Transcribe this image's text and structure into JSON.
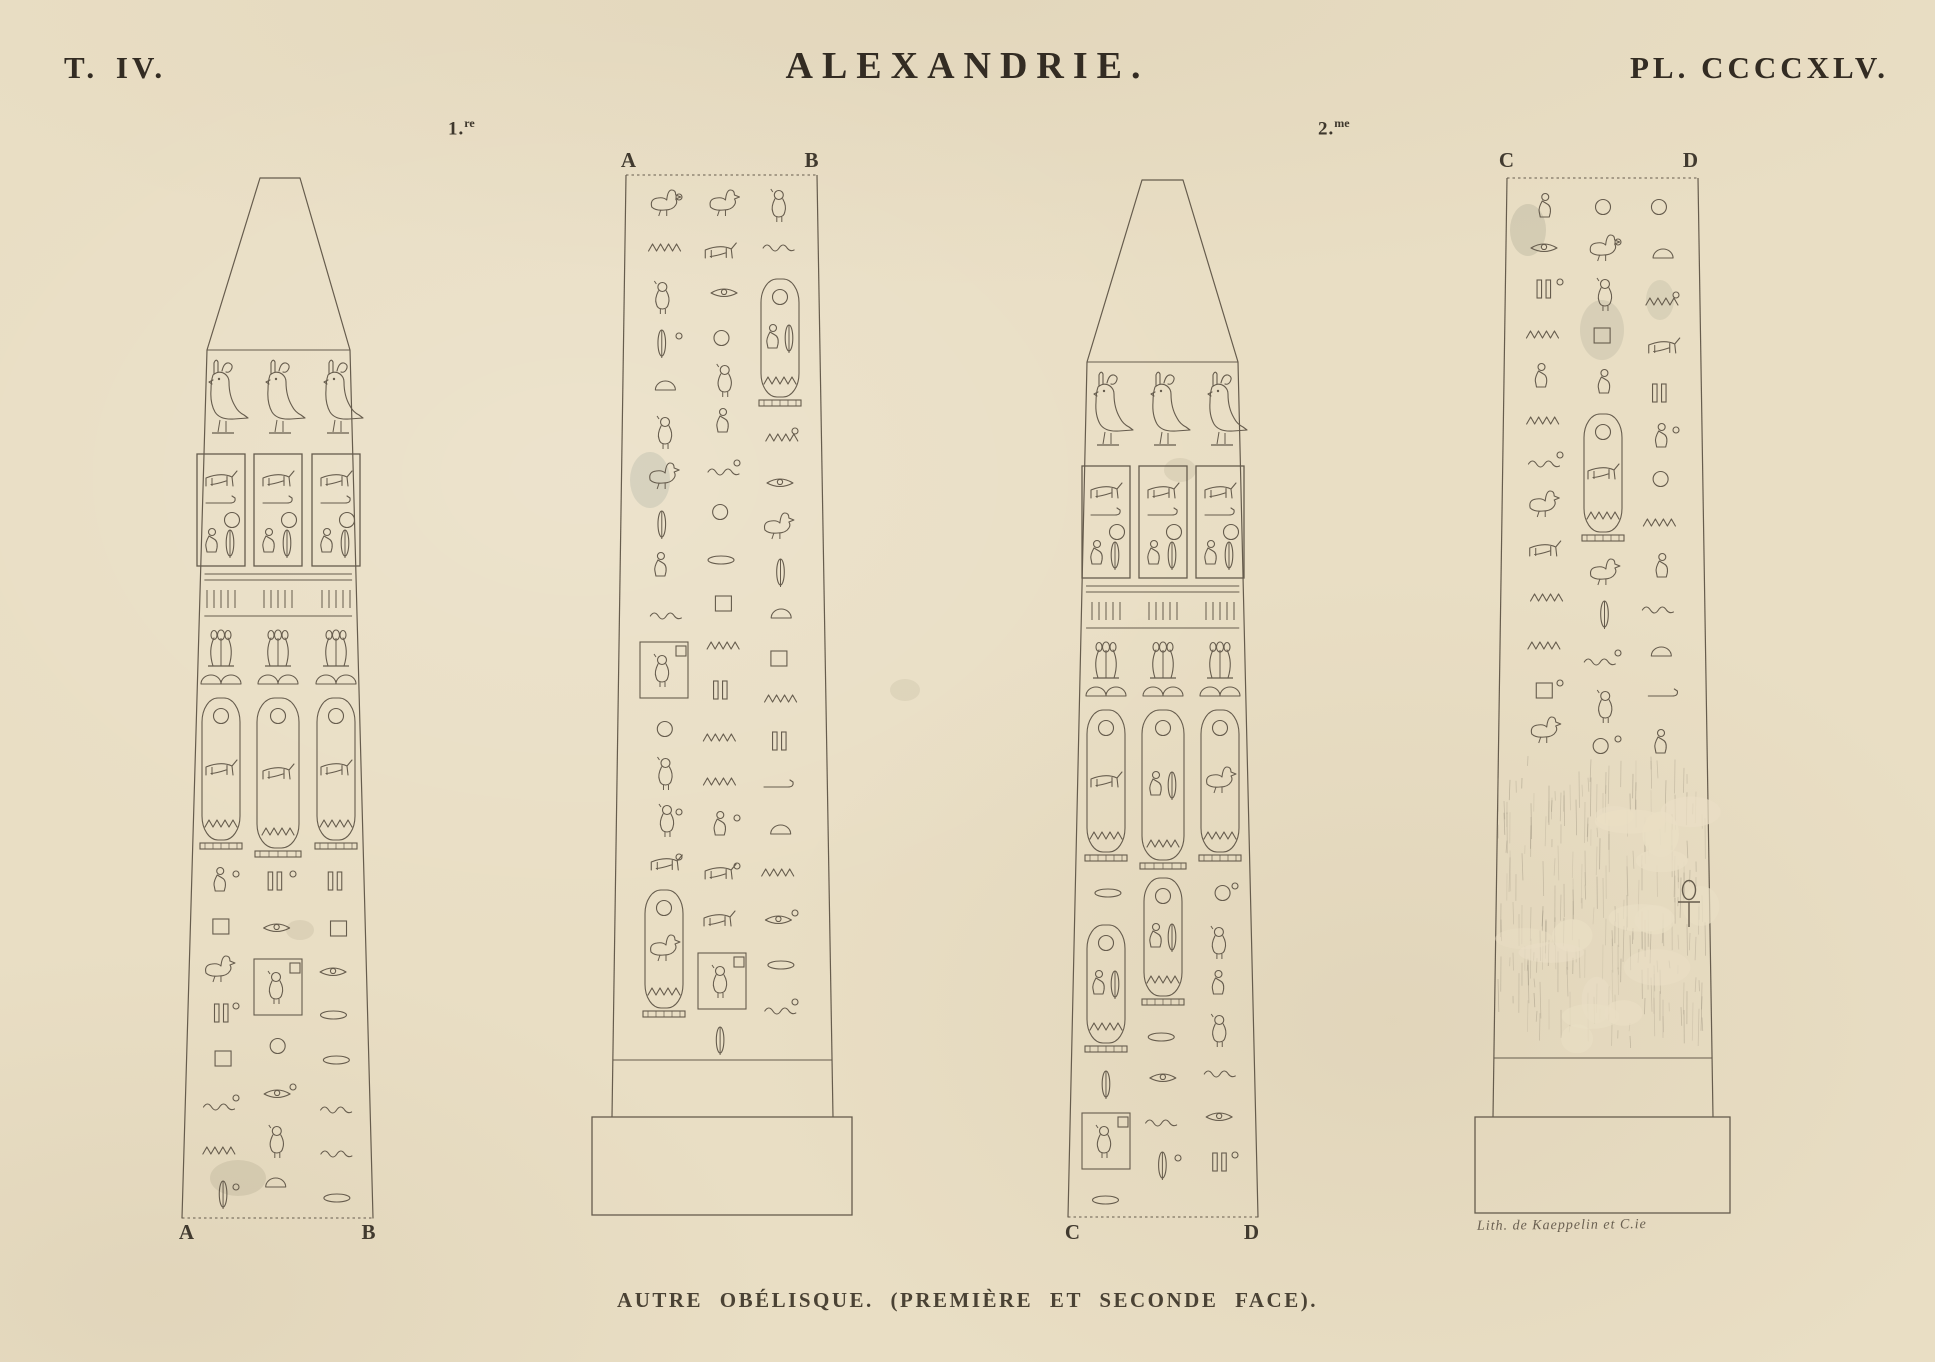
{
  "header": {
    "tome": "T. IV.",
    "title": "ALEXANDRIE.",
    "plate": "PL. CCCCXLV."
  },
  "face_labels": {
    "first": {
      "base": "1.",
      "sup": "re"
    },
    "second": {
      "base": "2.",
      "sup": "me"
    }
  },
  "obelisk_letters": [
    {
      "left": "A",
      "right": "B"
    },
    {
      "left": "A",
      "right": "B"
    },
    {
      "left": "C",
      "right": "D"
    },
    {
      "left": "C",
      "right": "D"
    }
  ],
  "caption": "AUTRE OBÉLISQUE. (PREMIÈRE ET SECONDE FACE).",
  "credit": "Lith. de Kaeppelin et C.ie",
  "colors": {
    "paper": "#e9dec4",
    "ink": "#665c4d",
    "text_ink": "#332c23",
    "erosion": "#8d8472"
  }
}
